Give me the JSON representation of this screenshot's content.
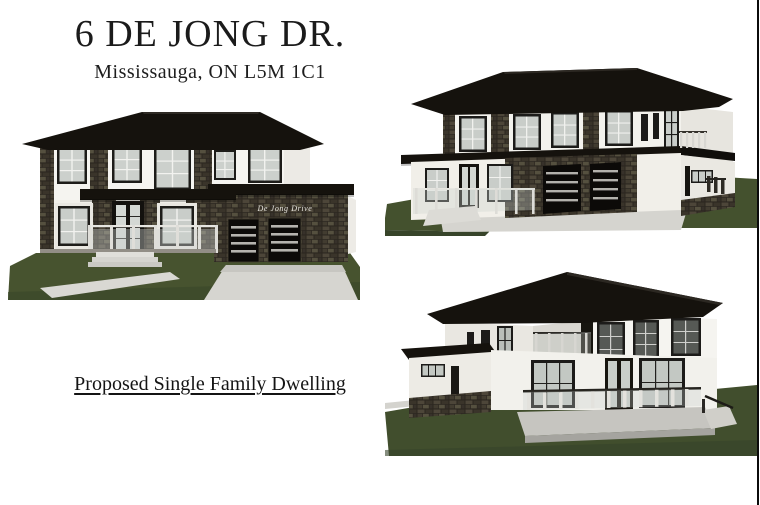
{
  "page": {
    "title": "6 DE JONG DR.",
    "subtitle": "Mississauga, ON L5M 1C1",
    "caption": "Proposed Single Family Dwelling",
    "garage_script_text": "De Jong Drive"
  },
  "colors": {
    "background": "#ffffff",
    "text": "#1b1b1b",
    "roof": "#15120d",
    "wall": "#f5f4f0",
    "stone": "#35302a",
    "lawn": "#44512e",
    "driveway": "#d6d5d0",
    "edge_line": "#0b0b0b"
  },
  "renderings": [
    {
      "id": "front-elevation"
    },
    {
      "id": "front-corner-perspective"
    },
    {
      "id": "rear-corner-perspective"
    }
  ]
}
